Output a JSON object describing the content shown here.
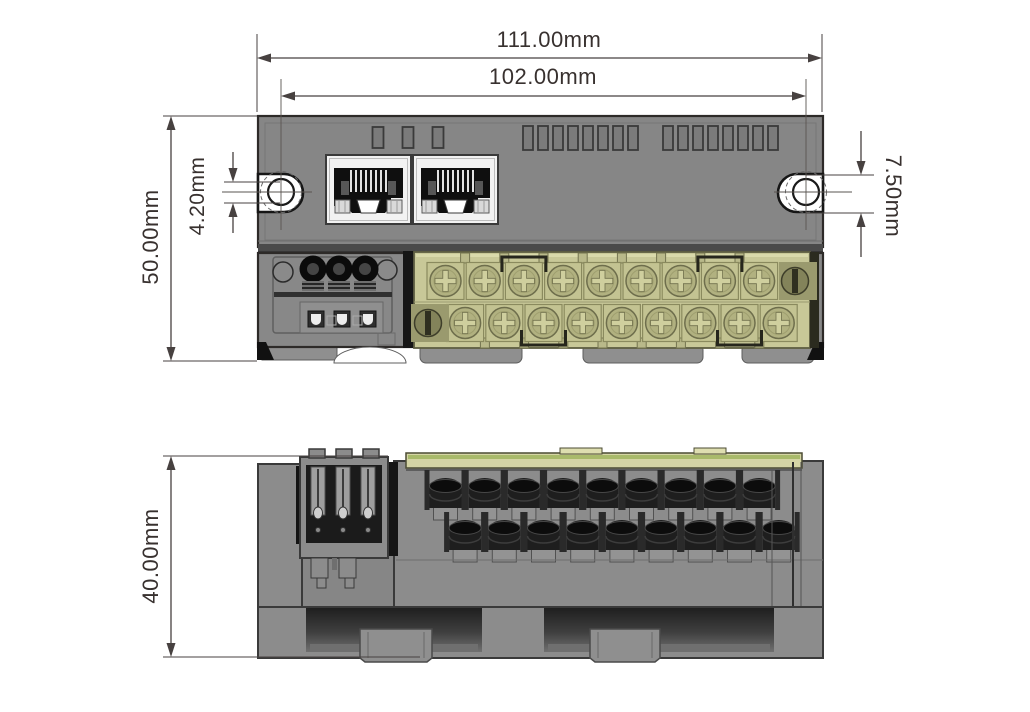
{
  "drawing": {
    "type": "mechanical-dimension-drawing",
    "background": "#ffffff",
    "colors": {
      "body_gray": "#868686",
      "outline": "#2d2a28",
      "terminal_block": "#c8c898",
      "terminal_screw": "#b1b180",
      "accent_green": "#a9ba6b",
      "jack_black": "#0f0f0f",
      "bezel_white": "#f2f2f2",
      "dimension_lines": "#474140",
      "dimension_text": "#38312f"
    }
  },
  "dims": {
    "overall_width": "111.00mm",
    "hole_spacing": "102.00mm",
    "front_height": "50.00mm",
    "hole_offset": "4.20mm",
    "slot_height": "7.50mm",
    "body_depth": "40.00mm"
  }
}
